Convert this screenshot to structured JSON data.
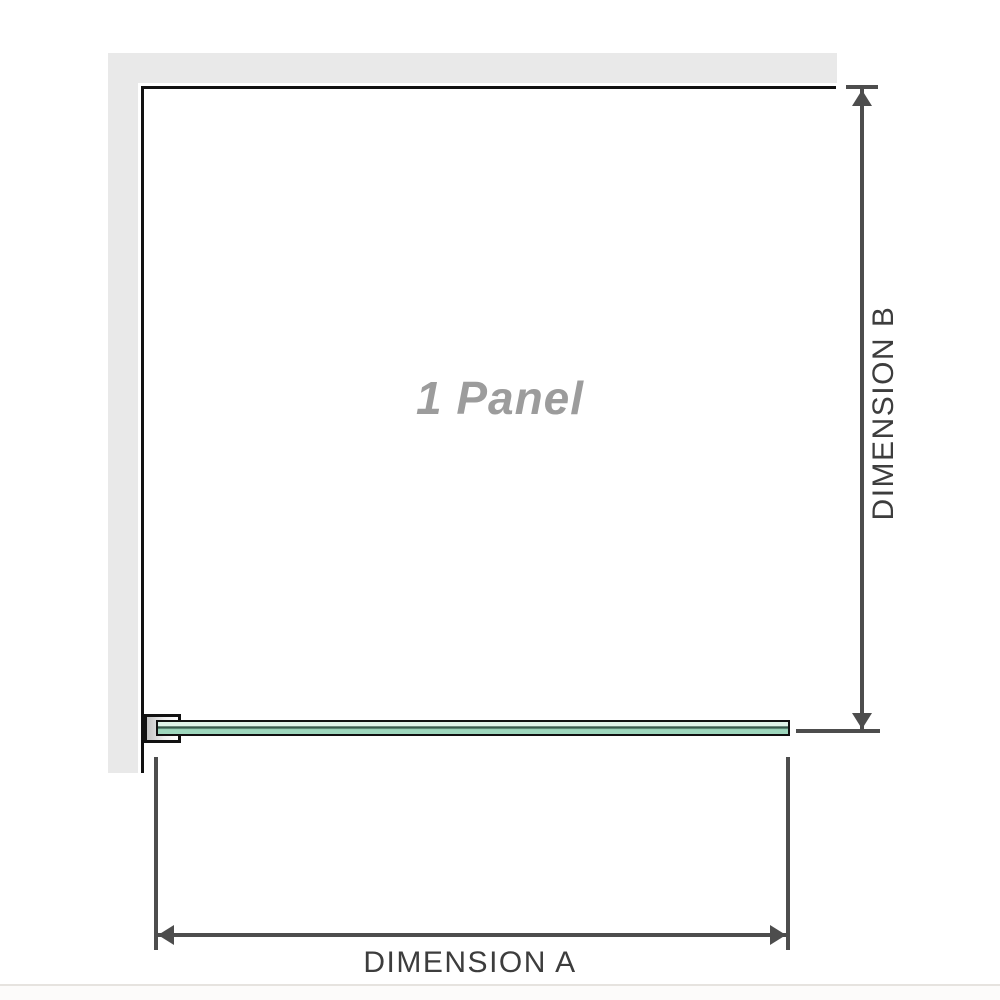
{
  "diagram": {
    "panel_label": "1 Panel",
    "dimension_a_label": "DIMENSION A",
    "dimension_b_label": "DIMENSION B"
  },
  "colors": {
    "wall": "#e9e9e9",
    "frame_outline": "#111111",
    "dimension_line": "#4d4d4d",
    "label_text": "#3d3d3d",
    "panel_label_text": "#9c9c9c",
    "glass_light": "#dff3e8",
    "glass_dark_stripe": "#36584a",
    "glass_mid": "#9ed7bd",
    "divider": "#e6e3df"
  }
}
